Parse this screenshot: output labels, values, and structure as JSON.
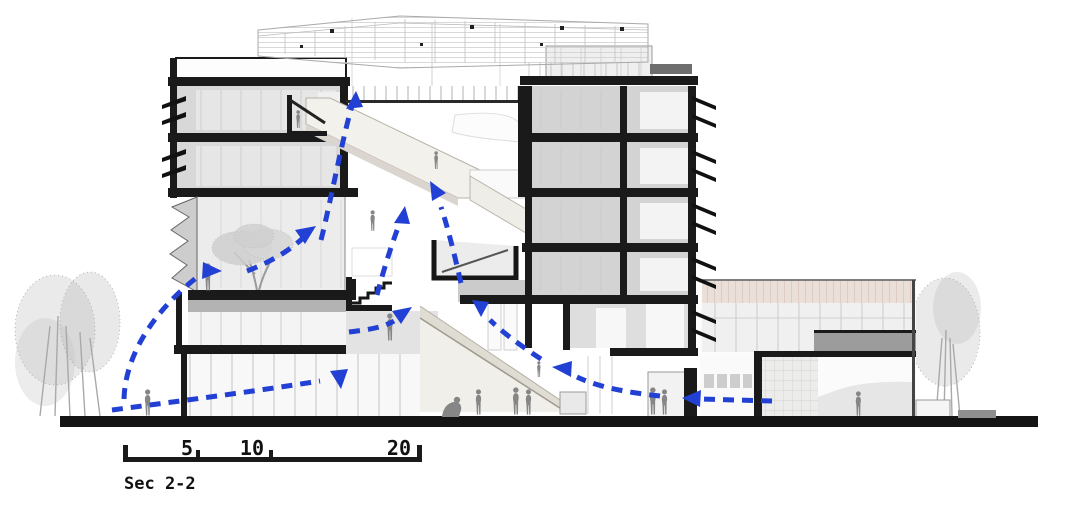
{
  "drawing": {
    "type": "architectural-section-diagram",
    "section_label": "Sec 2-2",
    "scale_bar": {
      "labels": [
        "5",
        "10",
        "20"
      ]
    },
    "colors": {
      "airflow_arrow": "#2240d4",
      "section_cut": "#1a1a1a",
      "ground": "#141414",
      "annex_screen_pink": "#eadfd9",
      "tree_gray": "#b5b5b5"
    },
    "airflow_arrows": [
      {
        "id": "entry-left-ground",
        "description": "air entering ground floor glazing from the left"
      },
      {
        "id": "entry-left-terrace",
        "description": "air curving up into the terrace level from outside left"
      },
      {
        "id": "terrace-to-upper",
        "description": "air rising from terrace toward the atrium"
      },
      {
        "id": "atrium-rise-left",
        "description": "long rise through the atrium past the stairs"
      },
      {
        "id": "atrium-rise-center",
        "description": "air rising in the centre of the atrium"
      },
      {
        "id": "terrace-stair-up",
        "description": "air moving up beside the small stair"
      },
      {
        "id": "annex-to-hall",
        "description": "air crossing from the annex into the main hall"
      },
      {
        "id": "ramp-ascent",
        "description": "air climbing along the big ramp"
      },
      {
        "id": "hall-to-atrium",
        "description": "air rising from the hall into the atrium"
      },
      {
        "id": "entry-right-ground",
        "description": "air entering at ground level from the right annex door"
      }
    ]
  }
}
